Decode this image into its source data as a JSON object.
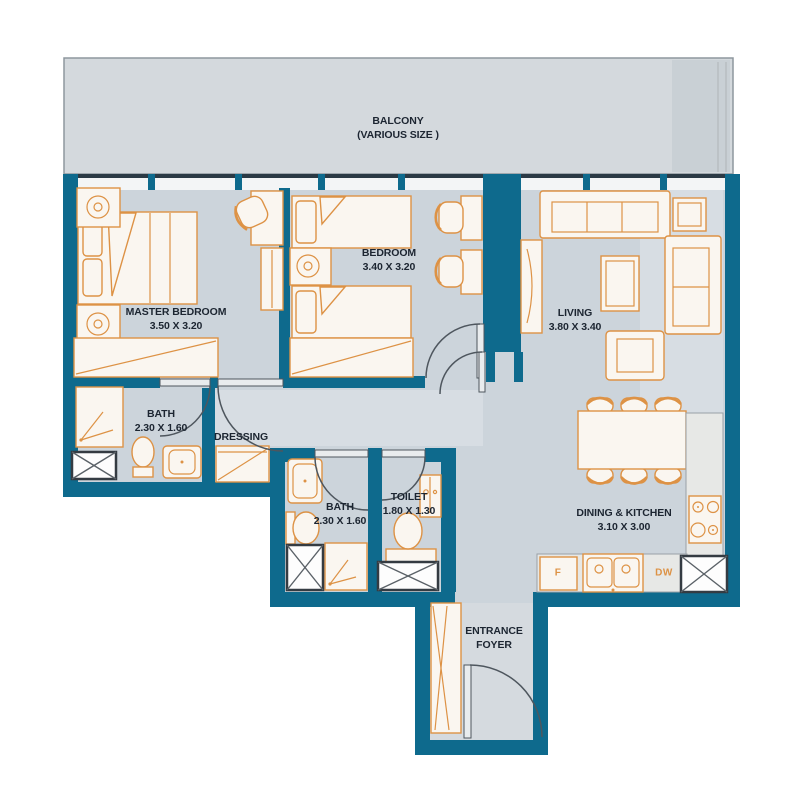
{
  "colors": {
    "wall": "#0e6a8d",
    "floor": "#ccd4db",
    "balcony_floor": "#d4d9dd",
    "window_glass": "#f3f5f6",
    "furniture_fill": "#faf6f0",
    "furniture_outline": "#dd9245",
    "label_text": "#1c2531",
    "door_swing": "#4e565e",
    "shaft_outline": "#343b42"
  },
  "balcony": {
    "name": "BALCONY",
    "size_note": "(VARIOUS SIZE )"
  },
  "rooms": {
    "master_bedroom": {
      "name": "MASTER BEDROOM",
      "dimensions": "3.50 X 3.20"
    },
    "bedroom": {
      "name": "BEDROOM",
      "dimensions": "3.40 X 3.20"
    },
    "living": {
      "name": "LIVING",
      "dimensions": "3.80 X 3.40"
    },
    "master_bath": {
      "name": "BATH",
      "dimensions": "2.30 X 1.60"
    },
    "dressing": {
      "name": "DRESSING"
    },
    "shared_bath": {
      "name": "BATH",
      "dimensions": "2.30 X 1.60"
    },
    "toilet": {
      "name": "TOILET",
      "dimensions": "1.80 X 1.30"
    },
    "dining_kitchen": {
      "name": "DINING & KITCHEN",
      "dimensions": "3.10 X 3.00"
    },
    "entrance_foyer": {
      "line1": "ENTRANCE",
      "line2": "FOYER"
    }
  },
  "appliances": {
    "fridge_label": "F",
    "dishwasher_label": "DW"
  }
}
